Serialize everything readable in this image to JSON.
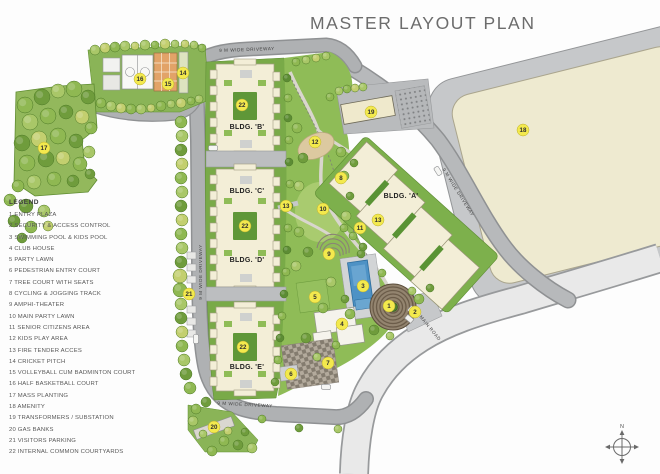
{
  "title": "MASTER LAYOUT PLAN",
  "legend": {
    "heading": "LEGEND",
    "items": [
      {
        "num": "1",
        "label": "ENTRY PLAZA"
      },
      {
        "num": "2",
        "label": "SECURITY & ACCESS CONTROL"
      },
      {
        "num": "3",
        "label": "SWIMMING POOL & KIDS POOL"
      },
      {
        "num": "4",
        "label": "CLUB HOUSE"
      },
      {
        "num": "5",
        "label": "PARTY LAWN"
      },
      {
        "num": "6",
        "label": "PEDESTRIAN ENTRY COURT"
      },
      {
        "num": "7",
        "label": "TREE COURT WITH SEATS"
      },
      {
        "num": "8",
        "label": "CYCLING & JOGGING TRACK"
      },
      {
        "num": "9",
        "label": "AMPHI-THEATER"
      },
      {
        "num": "10",
        "label": "MAIN PARTY LAWN"
      },
      {
        "num": "11",
        "label": "SENIOR CITIZENS AREA"
      },
      {
        "num": "12",
        "label": "KIDS PLAY AREA"
      },
      {
        "num": "13",
        "label": "FIRE TENDER ACCES"
      },
      {
        "num": "14",
        "label": "CRICKET PITCH"
      },
      {
        "num": "15",
        "label": "VOLLEYBALL CUM BADMINTON COURT"
      },
      {
        "num": "16",
        "label": "HALF BASKETBALL COURT"
      },
      {
        "num": "17",
        "label": "MASS PLANTING"
      },
      {
        "num": "18",
        "label": "AMENITY"
      },
      {
        "num": "19",
        "label": "TRANSFORMERS / SUBSTATION"
      },
      {
        "num": "20",
        "label": "GAS BANKS"
      },
      {
        "num": "21",
        "label": "VISITORS PARKING"
      },
      {
        "num": "22",
        "label": "INTERNAL COMMON COURTYARDS"
      }
    ]
  },
  "buildings": [
    {
      "id": "A",
      "label": "BLDG. 'A'"
    },
    {
      "id": "B",
      "label": "BLDG. 'B'"
    },
    {
      "id": "C",
      "label": "BLDG. 'C'"
    },
    {
      "id": "D",
      "label": "BLDG. 'D'"
    },
    {
      "id": "E",
      "label": "BLDG. 'E'"
    }
  ],
  "road_labels": [
    {
      "text": "9 M WIDE DRIVEWAY",
      "x": 247,
      "y": 51,
      "rotate": -2
    },
    {
      "text": "9 M WIDE DRIVEWAY",
      "x": 202,
      "y": 272,
      "rotate": -90
    },
    {
      "text": "9 M WIDE DRIVEWAY",
      "x": 245,
      "y": 406,
      "rotate": 3
    },
    {
      "text": "9 M WIDE DRIVEWAY",
      "x": 457,
      "y": 193,
      "rotate": 58
    },
    {
      "text": "MAIN ROAD",
      "x": 429,
      "y": 329,
      "rotate": 51
    }
  ],
  "markers": [
    {
      "num": "1",
      "x": 389,
      "y": 306
    },
    {
      "num": "2",
      "x": 415,
      "y": 312
    },
    {
      "num": "3",
      "x": 363,
      "y": 286
    },
    {
      "num": "4",
      "x": 342,
      "y": 324
    },
    {
      "num": "5",
      "x": 315,
      "y": 297
    },
    {
      "num": "6",
      "x": 291,
      "y": 374
    },
    {
      "num": "7",
      "x": 328,
      "y": 363
    },
    {
      "num": "8",
      "x": 341,
      "y": 178
    },
    {
      "num": "9",
      "x": 329,
      "y": 254
    },
    {
      "num": "10",
      "x": 323,
      "y": 209
    },
    {
      "num": "11",
      "x": 360,
      "y": 228
    },
    {
      "num": "12",
      "x": 315,
      "y": 142
    },
    {
      "num": "13",
      "x": 286,
      "y": 206
    },
    {
      "num": "13",
      "x": 378,
      "y": 220
    },
    {
      "num": "14",
      "x": 183,
      "y": 73
    },
    {
      "num": "15",
      "x": 168,
      "y": 84
    },
    {
      "num": "16",
      "x": 140,
      "y": 79
    },
    {
      "num": "17",
      "x": 44,
      "y": 148
    },
    {
      "num": "18",
      "x": 523,
      "y": 130
    },
    {
      "num": "19",
      "x": 371,
      "y": 112
    },
    {
      "num": "20",
      "x": 214,
      "y": 427
    },
    {
      "num": "21",
      "x": 189,
      "y": 294
    },
    {
      "num": "22",
      "x": 242,
      "y": 105
    },
    {
      "num": "22",
      "x": 245,
      "y": 226
    },
    {
      "num": "22",
      "x": 243,
      "y": 347
    }
  ],
  "compass": {
    "label": "N"
  },
  "colors": {
    "marker_fill": "#f3e94d",
    "marker_stroke": "#b9ae33",
    "marker_text": "#2f2f2f",
    "road_gray": "#afb1b3",
    "road_edge": "#8f9193",
    "building_cream": "#f3eed7",
    "amenity_cream": "#eeead0",
    "pool_blue": "#4e92c5",
    "court_orange": "#e2a368",
    "site_green": "#8fbc57",
    "band_green": "#79aa48",
    "tree_shades": [
      "#6f9c3c",
      "#8fb852",
      "#a9c768",
      "#c3cf6f",
      "#5c8c34"
    ]
  },
  "trees": [
    [
      25,
      105,
      8,
      1
    ],
    [
      42,
      97,
      8,
      0
    ],
    [
      58,
      91,
      7,
      2
    ],
    [
      74,
      89,
      8,
      1
    ],
    [
      88,
      97,
      7,
      0
    ],
    [
      30,
      122,
      8,
      2
    ],
    [
      48,
      116,
      8,
      1
    ],
    [
      66,
      112,
      7,
      0
    ],
    [
      82,
      117,
      7,
      3
    ],
    [
      91,
      128,
      6,
      1
    ],
    [
      22,
      143,
      8,
      0
    ],
    [
      39,
      139,
      8,
      3
    ],
    [
      58,
      136,
      8,
      1
    ],
    [
      76,
      141,
      7,
      0
    ],
    [
      89,
      152,
      6,
      2
    ],
    [
      27,
      163,
      8,
      1
    ],
    [
      46,
      159,
      8,
      0
    ],
    [
      63,
      158,
      7,
      3
    ],
    [
      80,
      164,
      7,
      1
    ],
    [
      90,
      174,
      5,
      0
    ],
    [
      34,
      182,
      7,
      2
    ],
    [
      54,
      179,
      7,
      1
    ],
    [
      73,
      181,
      6,
      0
    ],
    [
      18,
      186,
      6,
      1
    ],
    [
      10,
      200,
      6,
      1
    ],
    [
      26,
      206,
      7,
      0
    ],
    [
      44,
      211,
      6,
      2
    ],
    [
      14,
      221,
      6,
      0
    ],
    [
      31,
      227,
      6,
      1
    ],
    [
      48,
      226,
      5,
      3
    ],
    [
      22,
      238,
      5,
      0
    ],
    [
      95,
      50,
      5,
      2
    ],
    [
      105,
      48,
      5,
      3
    ],
    [
      115,
      47,
      5,
      1
    ],
    [
      125,
      46,
      5,
      2
    ],
    [
      135,
      46,
      4,
      3
    ],
    [
      145,
      45,
      5,
      2
    ],
    [
      155,
      45,
      4,
      1
    ],
    [
      165,
      44,
      5,
      3
    ],
    [
      175,
      44,
      4,
      2
    ],
    [
      185,
      44,
      4,
      3
    ],
    [
      194,
      45,
      4,
      2
    ],
    [
      202,
      48,
      4,
      1
    ],
    [
      101,
      103,
      5,
      1
    ],
    [
      111,
      106,
      5,
      2
    ],
    [
      121,
      108,
      5,
      3
    ],
    [
      131,
      109,
      5,
      1
    ],
    [
      141,
      109,
      5,
      2
    ],
    [
      151,
      108,
      4,
      3
    ],
    [
      161,
      106,
      5,
      1
    ],
    [
      171,
      104,
      4,
      2
    ],
    [
      181,
      103,
      5,
      3
    ],
    [
      191,
      101,
      4,
      1
    ],
    [
      199,
      99,
      4,
      2
    ],
    [
      181,
      122,
      6,
      1
    ],
    [
      182,
      136,
      6,
      2
    ],
    [
      181,
      150,
      6,
      0
    ],
    [
      182,
      164,
      6,
      3
    ],
    [
      181,
      178,
      6,
      1
    ],
    [
      182,
      192,
      6,
      2
    ],
    [
      181,
      206,
      6,
      0
    ],
    [
      182,
      220,
      6,
      3
    ],
    [
      181,
      234,
      6,
      1
    ],
    [
      182,
      248,
      6,
      2
    ],
    [
      181,
      262,
      6,
      0
    ],
    [
      180,
      276,
      7,
      3
    ],
    [
      180,
      290,
      7,
      1
    ],
    [
      181,
      304,
      6,
      2
    ],
    [
      181,
      318,
      6,
      0
    ],
    [
      182,
      332,
      6,
      3
    ],
    [
      182,
      346,
      6,
      1
    ],
    [
      184,
      360,
      6,
      2
    ],
    [
      186,
      374,
      6,
      0
    ],
    [
      190,
      388,
      6,
      1
    ],
    [
      287,
      78,
      4,
      4
    ],
    [
      288,
      98,
      4,
      1
    ],
    [
      288,
      118,
      4,
      4
    ],
    [
      289,
      140,
      4,
      1
    ],
    [
      289,
      162,
      4,
      4
    ],
    [
      290,
      184,
      4,
      1
    ],
    [
      289,
      206,
      4,
      4
    ],
    [
      288,
      228,
      4,
      1
    ],
    [
      287,
      250,
      4,
      4
    ],
    [
      286,
      272,
      4,
      1
    ],
    [
      284,
      294,
      4,
      4
    ],
    [
      282,
      316,
      4,
      1
    ],
    [
      280,
      338,
      4,
      4
    ],
    [
      278,
      360,
      4,
      1
    ],
    [
      275,
      382,
      4,
      0
    ],
    [
      296,
      62,
      4,
      1
    ],
    [
      306,
      60,
      4,
      2
    ],
    [
      316,
      58,
      4,
      3
    ],
    [
      326,
      56,
      4,
      2
    ],
    [
      297,
      128,
      5,
      1
    ],
    [
      303,
      158,
      5,
      0
    ],
    [
      299,
      186,
      5,
      2
    ],
    [
      341,
      152,
      5,
      1
    ],
    [
      354,
      163,
      4,
      0
    ],
    [
      299,
      232,
      5,
      1
    ],
    [
      308,
      252,
      5,
      0
    ],
    [
      296,
      266,
      5,
      2
    ],
    [
      344,
      228,
      4,
      1
    ],
    [
      363,
      247,
      4,
      0
    ],
    [
      331,
      282,
      5,
      2
    ],
    [
      323,
      308,
      5,
      1
    ],
    [
      306,
      338,
      5,
      0
    ],
    [
      350,
      314,
      5,
      1
    ],
    [
      374,
      330,
      5,
      0
    ],
    [
      390,
      336,
      4,
      2
    ],
    [
      419,
      299,
      5,
      1
    ],
    [
      430,
      288,
      4,
      0
    ],
    [
      382,
      273,
      4,
      1
    ],
    [
      412,
      291,
      4,
      2
    ],
    [
      345,
      299,
      4,
      0
    ],
    [
      336,
      345,
      4,
      1
    ],
    [
      317,
      357,
      4,
      2
    ],
    [
      344,
      176,
      5,
      1
    ],
    [
      350,
      196,
      4,
      0
    ],
    [
      346,
      216,
      5,
      2
    ],
    [
      353,
      236,
      4,
      1
    ],
    [
      361,
      254,
      4,
      0
    ],
    [
      339,
      91,
      4,
      2
    ],
    [
      347,
      89,
      4,
      1
    ],
    [
      355,
      88,
      4,
      3
    ],
    [
      363,
      87,
      4,
      2
    ],
    [
      330,
      97,
      4,
      1
    ],
    [
      196,
      409,
      5,
      1
    ],
    [
      206,
      402,
      5,
      0
    ],
    [
      193,
      421,
      5,
      2
    ],
    [
      224,
      441,
      5,
      1
    ],
    [
      238,
      445,
      5,
      0
    ],
    [
      252,
      448,
      5,
      2
    ],
    [
      212,
      451,
      5,
      1
    ],
    [
      228,
      431,
      4,
      3
    ],
    [
      245,
      432,
      4,
      0
    ],
    [
      203,
      434,
      4,
      2
    ],
    [
      262,
      419,
      4,
      1
    ],
    [
      299,
      428,
      4,
      0
    ],
    [
      338,
      429,
      4,
      2
    ]
  ],
  "parking_bays": [
    [
      187,
      252
    ],
    [
      187,
      264
    ],
    [
      187,
      276
    ],
    [
      187,
      306
    ],
    [
      187,
      318
    ],
    [
      187,
      330
    ]
  ],
  "cars": [
    {
      "x": 213,
      "y": 148,
      "rot": 0
    },
    {
      "x": 438,
      "y": 171,
      "rot": 58
    },
    {
      "x": 326,
      "y": 387,
      "rot": 3
    },
    {
      "x": 196,
      "y": 339,
      "rot": 90
    }
  ]
}
